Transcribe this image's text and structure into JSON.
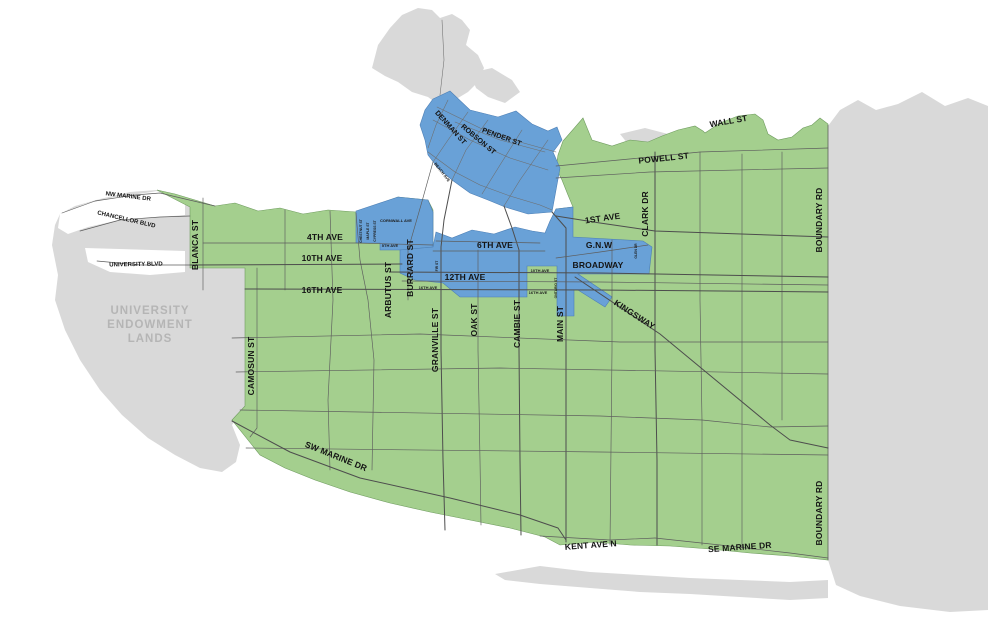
{
  "map_context": {
    "city": "Vancouver street map",
    "legend_implied": {
      "green_area": "City of Vancouver",
      "blue_area": "Highlighted central corridor zones",
      "gray_area": "Areas outside city (University Endowment Lands, Burnaby, waterfront lands)"
    }
  },
  "colors": {
    "city_green": "#a4cf8e",
    "zone_blue": "#69a1d7",
    "outside_gray": "#d9d9d9",
    "water_white": "#ffffff",
    "road_line": "#4d4d4d",
    "label_black": "#141414",
    "area_label_gray": "#b5b5b5"
  },
  "areas": {
    "uel_line1": "UNIVERSITY",
    "uel_line2": "ENDOWMENT",
    "uel_line3": "LANDS"
  },
  "streets": {
    "wall_st": "WALL ST",
    "powell_st": "POWELL ST",
    "denman_st": "DENMAN ST",
    "robson_st": "ROBSON ST",
    "pender_st": "PENDER ST",
    "beach_ave": "BEACH AVE",
    "cornwall_ave": "CORNWALL AVE",
    "first_ave": "1ST AVE",
    "clark_dr": "CLARK DR",
    "glen_dr": "GLEN DR",
    "gnw": "G.N.W",
    "broadway": "BROADWAY",
    "kingsway": "KINGSWAY",
    "fourth_ave": "4TH AVE",
    "tenth_ave": "10TH AVE",
    "sixteenth_ave": "16TH AVE",
    "sixth_ave": "6TH AVE",
    "twelfth_ave": "12TH AVE",
    "fifth_ave_tag": "5TH AVE",
    "tag_10th_ave": "10TH AVE",
    "tag_16th_ave_east": "16TH AVE",
    "tag_16th_ave_west": "16TH AVE",
    "fir_st": "FIR ST",
    "chestnut_st": "CHESTNUT ST",
    "maple_st": "MAPLE ST",
    "cypress_st": "CYPRESS ST",
    "ontario_st": "ONTARIO ST",
    "arbutus_st": "ARBUTUS ST",
    "burrard_st": "BURRARD ST",
    "granville_st": "GRANVILLE ST",
    "oak_st": "OAK ST",
    "cambie_st": "CAMBIE ST",
    "main_st": "MAIN ST",
    "blanca_st": "BLANCA ST",
    "camosun_st": "CAMOSUN ST",
    "nw_marine_dr": "NW MARINE DR",
    "chancellor_blvd": "CHANCELLOR BLVD",
    "university_blvd": "UNIVERSITY BLVD",
    "sw_marine_dr": "SW MARINE DR",
    "kent_ave_n": "KENT AVE N",
    "se_marine_dr": "SE MARINE DR",
    "boundary_rd_north": "BOUNDARY RD",
    "boundary_rd_south": "BOUNDARY RD"
  }
}
